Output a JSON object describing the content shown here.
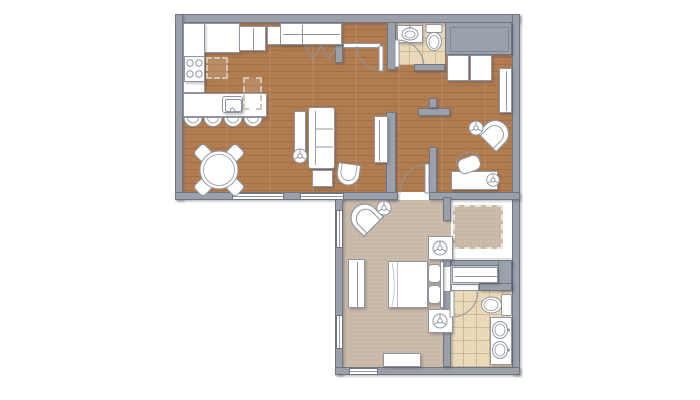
{
  "palette": {
    "background": "#ffffff",
    "wall": "#9ba1ab",
    "wall_outline": "#70757f",
    "wood_floor": "#b17c50",
    "carpet": "#c9b8a7",
    "tile": "#ead9b9",
    "furniture": "#ffffff",
    "furniture_outline": "#8f95a0",
    "dash": "#cfc6b6"
  },
  "plan": {
    "rooms": [
      {
        "name": "kitchen",
        "floor": "wood"
      },
      {
        "name": "living-dining",
        "floor": "wood"
      },
      {
        "name": "entry",
        "floor": "wood"
      },
      {
        "name": "powder-room",
        "floor": "tile"
      },
      {
        "name": "hall",
        "floor": "wood"
      },
      {
        "name": "den",
        "floor": "wood"
      },
      {
        "name": "bedroom",
        "floor": "carpet"
      },
      {
        "name": "walk-in-closet",
        "floor": "carpet"
      },
      {
        "name": "bathroom",
        "floor": "tile"
      }
    ],
    "furniture_icons": [
      "cooktop-icon",
      "island-sink-icon",
      "bar-stool-icon",
      "refrigerator-icon",
      "upper-cabinet-icon",
      "entry-closet-icon",
      "bifold-door-icon",
      "dining-table-icon",
      "dining-chair-icon",
      "sofa-icon",
      "console-table-icon",
      "plant-icon",
      "end-table-icon",
      "accent-chair-icon",
      "tv-console-icon",
      "powder-sink-icon",
      "toilet-icon",
      "storage-cabinet-icon",
      "hall-closet-icon",
      "lounge-chair-icon",
      "side-table-lamp-icon",
      "desk-icon",
      "office-chair-icon",
      "bed-icon",
      "pillow-icon",
      "nightstand-icon",
      "table-lamp-icon",
      "dresser-icon",
      "bench-icon",
      "closet-shelving-icon",
      "linen-cabinet-icon",
      "double-vanity-icon",
      "door-swing-icon",
      "window-icon"
    ]
  }
}
